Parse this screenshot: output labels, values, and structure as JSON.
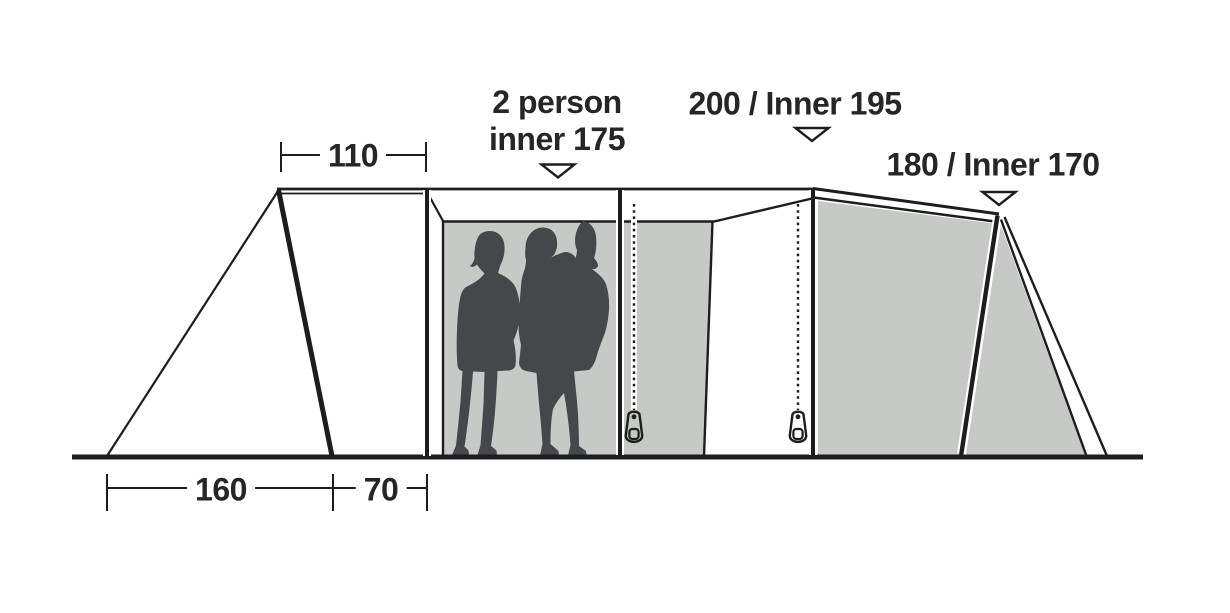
{
  "diagram": {
    "title": "tent side profile dimension diagram",
    "labels": {
      "left_room": {
        "line1": "2 person",
        "line2": "inner 175"
      },
      "mid_room": "200 / Inner 195",
      "right_room": "180 / Inner 170"
    },
    "dimensions": {
      "awning_top_width": "110",
      "ground_left_span": "160",
      "ground_mid_span": "70"
    },
    "icons": {
      "pointer_marker": "triangle-down-marker",
      "zipper_pull": "zipper-pull",
      "people": "family-silhouette"
    },
    "colors": {
      "background": "#ffffff",
      "line": "#1d1d1d",
      "inner_tent_fill": "#c6c9c6",
      "silhouette": "#45484b",
      "text": "#262626"
    }
  }
}
